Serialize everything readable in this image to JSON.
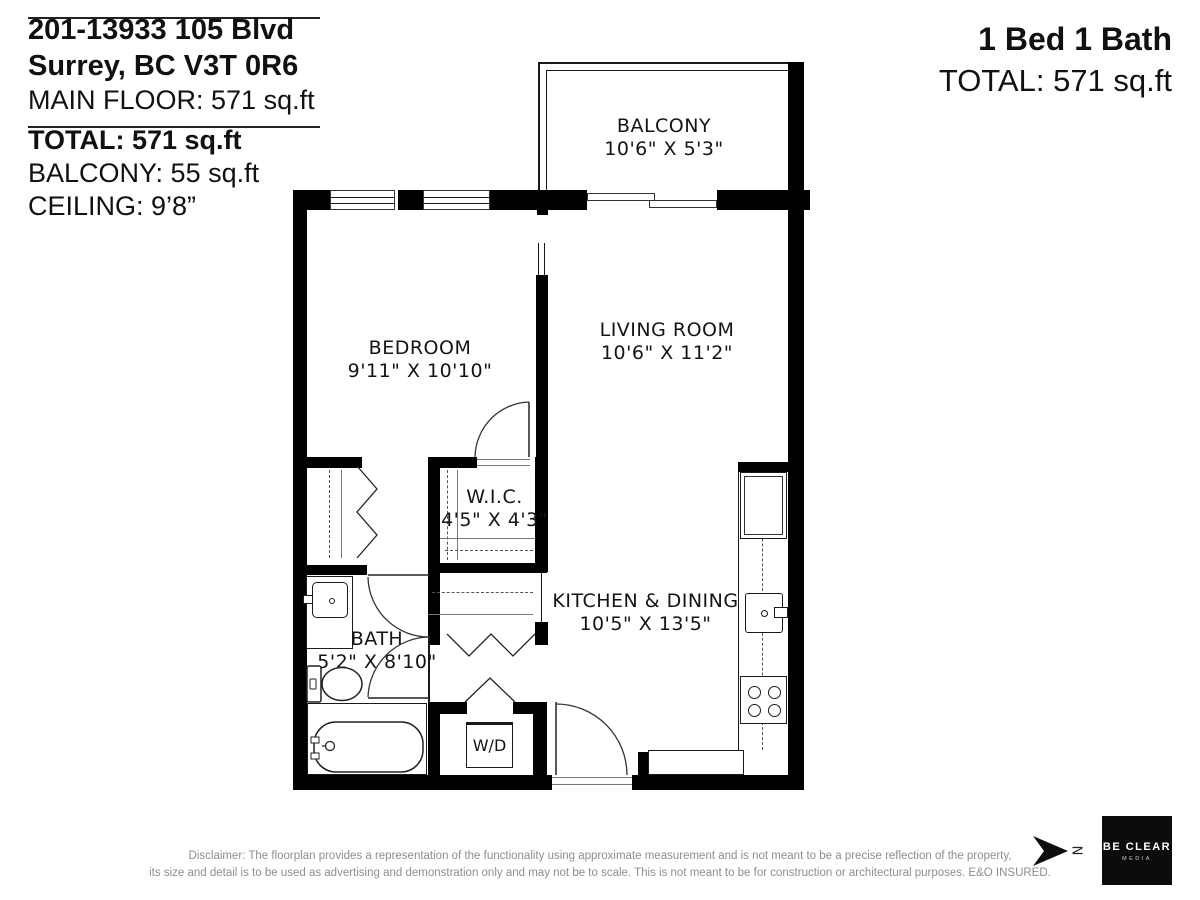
{
  "header_left": {
    "address_line1": "201-13933 105 Blvd",
    "address_line2": "Surrey, BC V3T 0R6",
    "main_floor": "MAIN FLOOR: 571 sq.ft",
    "total": "TOTAL: 571 sq.ft",
    "balcony": "BALCONY: 55 sq.ft",
    "ceiling": "CEILING: 9’8”"
  },
  "header_right": {
    "beds_baths": "1 Bed 1 Bath",
    "total": "TOTAL: 571 sq.ft"
  },
  "rooms": {
    "balcony": {
      "name": "BALCONY",
      "dims": "10'6\" X 5'3\""
    },
    "bedroom": {
      "name": "BEDROOM",
      "dims": "9'11\" X 10'10\""
    },
    "living_room": {
      "name": "LIVING ROOM",
      "dims": "10'6\" X 11'2\""
    },
    "wic": {
      "name": "W.I.C.",
      "dims": "4'5\" X 4'3\""
    },
    "kitchen_dining": {
      "name": "KITCHEN & DINING",
      "dims": "10'5\" X 13'5\""
    },
    "bath": {
      "name": "BATH",
      "dims": "5'2\" X 8'10\""
    },
    "laundry": {
      "name": "W/D"
    }
  },
  "footer": {
    "disclaimer_line1": "Disclaimer: The floorplan provides a representation of the functionality using approximate measurement and is not meant to be a precise reflection of the property,",
    "disclaimer_line2": "its size and detail is to be used as advertising and demonstration only and may not be to scale. This is not meant to be for construction or architectural purposes. E&O INSURED.",
    "north_label": "N",
    "logo_name": "BE CLEAR",
    "logo_subtitle": "MEDIA"
  },
  "colors": {
    "wall": "#000000",
    "background": "#ffffff",
    "disclaimer_text": "#8e8e8e",
    "logo_background": "#0c0c0c"
  }
}
